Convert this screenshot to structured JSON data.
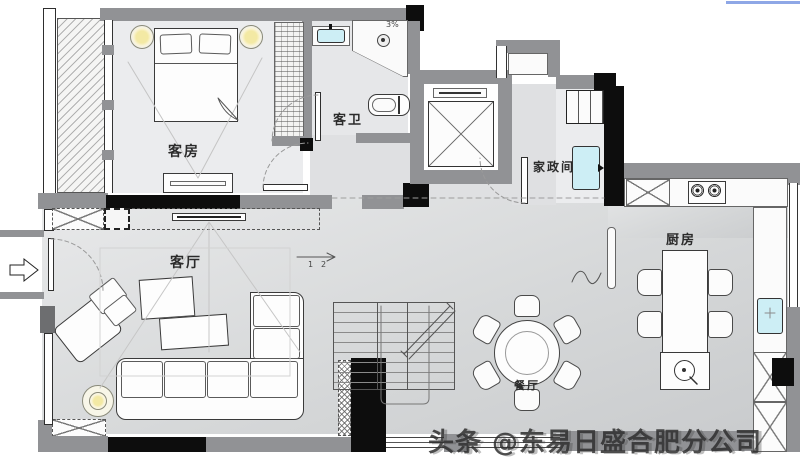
{
  "meta": {
    "width": 800,
    "height": 461,
    "type": "residential floor plan"
  },
  "rooms": {
    "guest_room": {
      "label": "客房"
    },
    "guest_bath": {
      "label": "客卫"
    },
    "laundry": {
      "label": "家政间"
    },
    "kitchen": {
      "label": "厨房"
    },
    "living_room": {
      "label": "客厅"
    },
    "dining_room": {
      "label": "餐厅"
    }
  },
  "annotations": {
    "shower_slope": "3%",
    "stair_step_1": "1",
    "stair_step_2": "2"
  },
  "watermark": {
    "text": "头条 @东易日盛合肥分公司"
  },
  "colors": {
    "wall_gray": "#919295",
    "wall_black": "#0d0d0d",
    "floor": "#d8dadb",
    "fixture_cyan": "#cdeef5",
    "lamp_yellow": "#f3e9a4",
    "top_accent_line": "#8ea7e6"
  }
}
